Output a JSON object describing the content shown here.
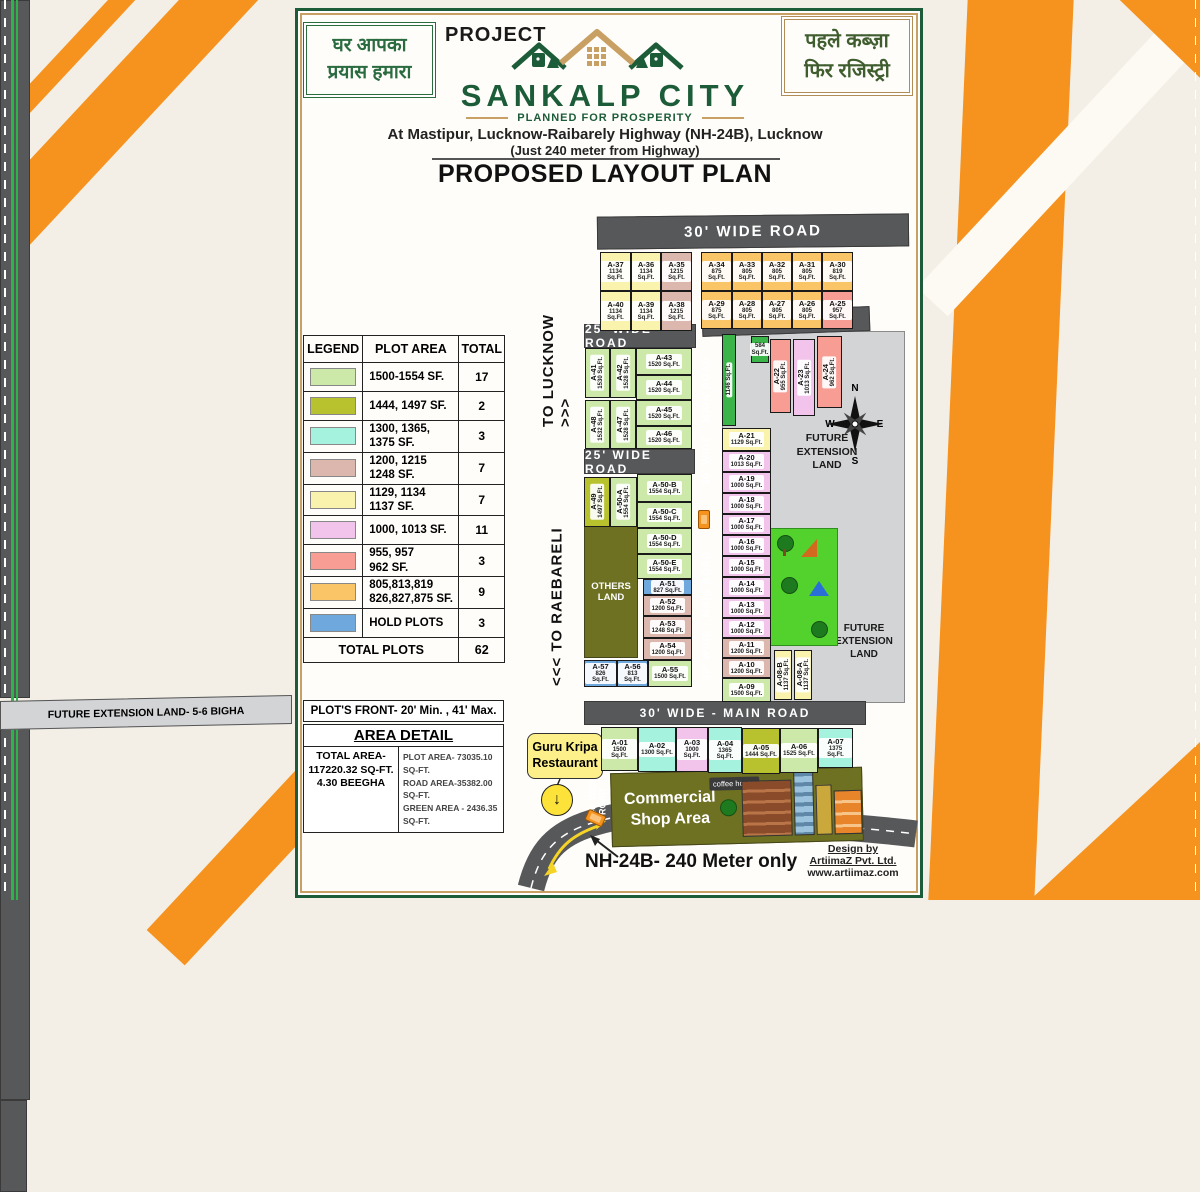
{
  "colors": {
    "brand_green": "#1d5c38",
    "brand_tan": "#c8a063",
    "ribbon_orange": "#f6921e",
    "road_gray": "#57585a"
  },
  "header": {
    "slogan_left": "घर आपका\nप्रयास हमारा",
    "slogan_right": "पहले कब्ज़ा\nफिर रजिस्ट्री",
    "project_label": "PROJECT",
    "name": "SANKALP CITY",
    "tagline": "PLANNED FOR PROSPERITY",
    "address1": "At Mastipur, Lucknow-Raibarely Highway (NH-24B), Lucknow",
    "address2": "(Just 240 meter from Highway)",
    "plan_title": "PROPOSED LAYOUT PLAN"
  },
  "legend": {
    "headers": [
      "LEGEND",
      "PLOT AREA",
      "TOTAL"
    ],
    "rows": [
      {
        "color": "#cde9a9",
        "label": "1500-1554 SF.",
        "total": "17"
      },
      {
        "color": "#b8c22e",
        "label": "1444, 1497 SF.",
        "total": "2"
      },
      {
        "color": "#a5f2df",
        "label": "1300, 1365,\n1375 SF.",
        "total": "3"
      },
      {
        "color": "#dcb7ad",
        "label": "1200, 1215\n1248 SF.",
        "total": "7"
      },
      {
        "color": "#faf3ae",
        "label": "1129, 1134\n1137 SF.",
        "total": "7"
      },
      {
        "color": "#f2c4ec",
        "label": "1000, 1013 SF.",
        "total": "11"
      },
      {
        "color": "#f89d94",
        "label": "955, 957\n962 SF.",
        "total": "3"
      },
      {
        "color": "#f9c567",
        "label": "805,813,819\n826,827,875 SF.",
        "total": "9"
      },
      {
        "color": "#6fa8dc",
        "label": "HOLD PLOTS",
        "total": "3"
      }
    ],
    "total_label": "TOTAL PLOTS",
    "total_value": "62",
    "front_note": "PLOT'S FRONT- 20' Min. , 41' Max."
  },
  "area_detail": {
    "title": "AREA DETAIL",
    "total_lines": "TOTAL AREA-\n117220.32 SQ-FT.\n4.30 BEEGHA",
    "detail_lines": "PLOT AREA- 73035.10 SQ-FT.\nROAD AREA-35382.00 SQ-FT.\nGREEN AREA - 2436.35 SQ-FT."
  },
  "map": {
    "future_top": "FUTURE EXTENSION LAND- 5-6 BIGHA",
    "future_ext": "FUTURE\nEXTENSION\nLAND",
    "others_land": "OTHERS\nLAND",
    "commercial_label": "Commercial\nShop Area",
    "coffee_label": "coffee house",
    "main_road_label": "30' WIDE - MAIN  ROAD",
    "entry_road_label": "40' WIDE - ENTRY ROAD",
    "highway": {
      "to_lucknow": "TO LUCKNOW >>>",
      "to_raebareli": "<<< TO RAEBARELI"
    },
    "compass": {
      "n": "N",
      "e": "E",
      "s": "S",
      "w": "W"
    },
    "roads": [
      {
        "label": "30' WIDE  ROAD",
        "x": 597,
        "y": 215,
        "w": 312,
        "h": 33,
        "fs": 15,
        "rot": -0.6
      },
      {
        "label": "25' WIDE ROAD",
        "x": 702,
        "y": 309,
        "w": 168,
        "h": 25,
        "fs": 12,
        "rot": -2
      },
      {
        "label": "25' WIDE ROAD",
        "x": 584,
        "y": 324,
        "w": 112,
        "h": 24,
        "fs": 12,
        "rot": 0
      },
      {
        "label": "25' WIDE  ROAD",
        "x": 584,
        "y": 449,
        "w": 111,
        "h": 25,
        "fs": 12,
        "rot": 0
      },
      {
        "label": "30' WIDE - MAIN  ROAD",
        "x": 584,
        "y": 701,
        "w": 282,
        "h": 24,
        "fs": 12,
        "rot": 0
      }
    ],
    "plot_colors": {
      "green": "#cde9a9",
      "olive": "#b8c22e",
      "cyan": "#a5f2df",
      "rose": "#dcb7ad",
      "yellow": "#faf3ae",
      "pink": "#f2c4ec",
      "salmon": "#f89d94",
      "orange": "#f9c567",
      "blue": "#6fa8dc",
      "garea": "#3bb54a"
    },
    "plots": [
      {
        "id": "A-37",
        "area": "1134 Sq.Ft.",
        "c": "yellow",
        "x": 600,
        "y": 252,
        "w": 31,
        "h": 39
      },
      {
        "id": "A-36",
        "area": "1134 Sq.Ft.",
        "c": "yellow",
        "x": 631,
        "y": 252,
        "w": 30,
        "h": 39
      },
      {
        "id": "A-35",
        "area": "1215 Sq.Ft.",
        "c": "rose",
        "x": 661,
        "y": 252,
        "w": 31,
        "h": 39
      },
      {
        "id": "A-40",
        "area": "1134 Sq.Ft.",
        "c": "yellow",
        "x": 600,
        "y": 291,
        "w": 31,
        "h": 40
      },
      {
        "id": "A-39",
        "area": "1134 Sq.Ft.",
        "c": "yellow",
        "x": 631,
        "y": 291,
        "w": 30,
        "h": 40
      },
      {
        "id": "A-38",
        "area": "1215 Sq.Ft.",
        "c": "rose",
        "x": 661,
        "y": 291,
        "w": 31,
        "h": 40
      },
      {
        "id": "A-34",
        "area": "875 Sq.Ft.",
        "c": "orange",
        "x": 701,
        "y": 252,
        "w": 31,
        "h": 39
      },
      {
        "id": "A-33",
        "area": "805 Sq.Ft.",
        "c": "orange",
        "x": 732,
        "y": 252,
        "w": 30,
        "h": 39
      },
      {
        "id": "A-32",
        "area": "805 Sq.Ft.",
        "c": "orange",
        "x": 762,
        "y": 252,
        "w": 30,
        "h": 39
      },
      {
        "id": "A-31",
        "area": "805 Sq.Ft.",
        "c": "orange",
        "x": 792,
        "y": 252,
        "w": 30,
        "h": 39
      },
      {
        "id": "A-30",
        "area": "819 Sq.Ft.",
        "c": "orange",
        "x": 822,
        "y": 252,
        "w": 31,
        "h": 39
      },
      {
        "id": "A-29",
        "area": "875 Sq.Ft.",
        "c": "orange",
        "x": 701,
        "y": 291,
        "w": 31,
        "h": 38
      },
      {
        "id": "A-28",
        "area": "805 Sq.Ft.",
        "c": "orange",
        "x": 732,
        "y": 291,
        "w": 30,
        "h": 38
      },
      {
        "id": "A-27",
        "area": "805 Sq.Ft.",
        "c": "orange",
        "x": 762,
        "y": 291,
        "w": 30,
        "h": 38
      },
      {
        "id": "A-26",
        "area": "805 Sq.Ft.",
        "c": "orange",
        "x": 792,
        "y": 291,
        "w": 30,
        "h": 38
      },
      {
        "id": "A-25",
        "area": "957 Sq.Ft.",
        "c": "salmon",
        "x": 822,
        "y": 291,
        "w": 31,
        "h": 38
      },
      {
        "id": "A-41",
        "area": "1530 Sq.Ft.",
        "c": "green",
        "x": 585,
        "y": 348,
        "w": 25,
        "h": 50,
        "rot": true
      },
      {
        "id": "A-42",
        "area": "1528 Sq.Ft.",
        "c": "green",
        "x": 610,
        "y": 348,
        "w": 26,
        "h": 50,
        "rot": true
      },
      {
        "id": "A-43",
        "area": "1520 Sq.Ft.",
        "c": "green",
        "x": 636,
        "y": 348,
        "w": 56,
        "h": 27
      },
      {
        "id": "A-44",
        "area": "1520 Sq.Ft.",
        "c": "green",
        "x": 636,
        "y": 375,
        "w": 56,
        "h": 25
      },
      {
        "id": "A-48",
        "area": "1532 Sq.Ft.",
        "c": "green",
        "x": 585,
        "y": 400,
        "w": 25,
        "h": 49,
        "rot": true
      },
      {
        "id": "A-47",
        "area": "1528 Sq.Ft.",
        "c": "green",
        "x": 610,
        "y": 400,
        "w": 26,
        "h": 49,
        "rot": true
      },
      {
        "id": "A-45",
        "area": "1520 Sq.Ft.",
        "c": "green",
        "x": 636,
        "y": 400,
        "w": 56,
        "h": 26
      },
      {
        "id": "A-46",
        "area": "1520 Sq.Ft.",
        "c": "green",
        "x": 636,
        "y": 426,
        "w": 56,
        "h": 23
      },
      {
        "id": "A-49",
        "area": "1497 Sq.Ft.",
        "c": "olive",
        "x": 584,
        "y": 477,
        "w": 26,
        "h": 50,
        "rot": true
      },
      {
        "id": "A-50-A",
        "area": "1554 Sq.Ft.",
        "c": "green",
        "x": 610,
        "y": 477,
        "w": 27,
        "h": 50,
        "rot": true
      },
      {
        "id": "A-50-B",
        "area": "1554 Sq.Ft.",
        "c": "green",
        "x": 637,
        "y": 474,
        "w": 55,
        "h": 28
      },
      {
        "id": "A-50-C",
        "area": "1554 Sq.Ft.",
        "c": "green",
        "x": 637,
        "y": 502,
        "w": 55,
        "h": 26
      },
      {
        "id": "A-50-D",
        "area": "1554 Sq.Ft.",
        "c": "green",
        "x": 637,
        "y": 528,
        "w": 55,
        "h": 26
      },
      {
        "id": "A-50-E",
        "area": "1554 Sq.Ft.",
        "c": "green",
        "x": 637,
        "y": 554,
        "w": 55,
        "h": 25
      },
      {
        "id": "A-51",
        "area": "827 Sq.Ft.",
        "c": "blue",
        "x": 643,
        "y": 579,
        "w": 49,
        "h": 16
      },
      {
        "id": "A-52",
        "area": "1200 Sq.Ft.",
        "c": "rose",
        "x": 643,
        "y": 595,
        "w": 49,
        "h": 21
      },
      {
        "id": "A-53",
        "area": "1248 Sq.Ft.",
        "c": "rose",
        "x": 643,
        "y": 616,
        "w": 49,
        "h": 22
      },
      {
        "id": "A-54",
        "area": "1200 Sq.Ft.",
        "c": "rose",
        "x": 643,
        "y": 638,
        "w": 49,
        "h": 22
      },
      {
        "id": "A-55",
        "area": "1500 Sq.Ft.",
        "c": "green",
        "x": 648,
        "y": 660,
        "w": 44,
        "h": 27
      },
      {
        "id": "A-56",
        "area": "813 Sq.Ft.",
        "c": "blue",
        "x": 617,
        "y": 660,
        "w": 31,
        "h": 27
      },
      {
        "id": "A-57",
        "area": "826 Sq.Ft.",
        "c": "blue",
        "x": 584,
        "y": 660,
        "w": 33,
        "h": 27
      },
      {
        "id": "A-21",
        "area": "1129 Sq.Ft.",
        "c": "yellow",
        "x": 722,
        "y": 428,
        "w": 49,
        "h": 23
      },
      {
        "id": "A-20",
        "area": "1013 Sq.Ft.",
        "c": "pink",
        "x": 722,
        "y": 451,
        "w": 49,
        "h": 21
      },
      {
        "id": "A-19",
        "area": "1000 Sq.Ft.",
        "c": "pink",
        "x": 722,
        "y": 472,
        "w": 49,
        "h": 21
      },
      {
        "id": "A-18",
        "area": "1000 Sq.Ft.",
        "c": "pink",
        "x": 722,
        "y": 493,
        "w": 49,
        "h": 21
      },
      {
        "id": "A-17",
        "area": "1000 Sq.Ft.",
        "c": "pink",
        "x": 722,
        "y": 514,
        "w": 49,
        "h": 21
      },
      {
        "id": "A-16",
        "area": "1000 Sq.Ft.",
        "c": "pink",
        "x": 722,
        "y": 535,
        "w": 49,
        "h": 21
      },
      {
        "id": "A-15",
        "area": "1000 Sq.Ft.",
        "c": "pink",
        "x": 722,
        "y": 556,
        "w": 49,
        "h": 21
      },
      {
        "id": "A-14",
        "area": "1000 Sq.Ft.",
        "c": "pink",
        "x": 722,
        "y": 577,
        "w": 49,
        "h": 21
      },
      {
        "id": "A-13",
        "area": "1000 Sq.Ft.",
        "c": "pink",
        "x": 722,
        "y": 598,
        "w": 49,
        "h": 20
      },
      {
        "id": "A-12",
        "area": "1000 Sq.Ft.",
        "c": "pink",
        "x": 722,
        "y": 618,
        "w": 49,
        "h": 20
      },
      {
        "id": "A-11",
        "area": "1200 Sq.Ft.",
        "c": "rose",
        "x": 722,
        "y": 638,
        "w": 49,
        "h": 20
      },
      {
        "id": "A-10",
        "area": "1200 Sq.Ft.",
        "c": "rose",
        "x": 722,
        "y": 658,
        "w": 49,
        "h": 20
      },
      {
        "id": "A-09",
        "area": "1500 Sq.Ft.",
        "c": "green",
        "x": 722,
        "y": 678,
        "w": 49,
        "h": 24
      },
      {
        "id": "A-08-B",
        "area": "1137 Sq.Ft.",
        "c": "yellow",
        "x": 774,
        "y": 650,
        "w": 18,
        "h": 50,
        "rot": true
      },
      {
        "id": "A-08-A",
        "area": "1137 Sq.Ft.",
        "c": "yellow",
        "x": 794,
        "y": 650,
        "w": 18,
        "h": 50,
        "rot": true
      },
      {
        "id": "A-22",
        "area": "955 Sq.Ft.",
        "c": "salmon",
        "x": 770,
        "y": 339,
        "w": 21,
        "h": 74,
        "rot": true
      },
      {
        "id": "A-23",
        "area": "1013 Sq.Ft.",
        "c": "pink",
        "x": 793,
        "y": 339,
        "w": 22,
        "h": 77,
        "rot": true
      },
      {
        "id": "A-24",
        "area": "962 Sq.Ft.",
        "c": "salmon",
        "x": 817,
        "y": 336,
        "w": 25,
        "h": 72,
        "rot": true
      },
      {
        "id": "",
        "area": "584 Sq.Ft.",
        "c": "garea",
        "x": 751,
        "y": 336,
        "w": 18,
        "h": 27
      },
      {
        "id": "",
        "area": "1146 Sq.Ft.",
        "c": "garea",
        "x": 722,
        "y": 334,
        "w": 14,
        "h": 92,
        "rot": true
      },
      {
        "id": "A-01",
        "area": "1500 Sq.Ft.",
        "c": "green",
        "x": 601,
        "y": 727,
        "w": 37,
        "h": 44
      },
      {
        "id": "A-02",
        "area": "1300 Sq.Ft.",
        "c": "cyan",
        "x": 638,
        "y": 727,
        "w": 38,
        "h": 45
      },
      {
        "id": "A-03",
        "area": "1000 Sq.Ft.",
        "c": "pink",
        "x": 676,
        "y": 727,
        "w": 32,
        "h": 45
      },
      {
        "id": "A-04",
        "area": "1365 Sq.Ft.",
        "c": "cyan",
        "x": 708,
        "y": 727,
        "w": 34,
        "h": 46
      },
      {
        "id": "A-05",
        "area": "1444 Sq.Ft.",
        "c": "olive",
        "x": 742,
        "y": 728,
        "w": 38,
        "h": 46
      },
      {
        "id": "A-06",
        "area": "1525 Sq.Ft.",
        "c": "green",
        "x": 780,
        "y": 728,
        "w": 38,
        "h": 45
      },
      {
        "id": "A-07",
        "area": "1375 Sq.Ft.",
        "c": "cyan",
        "x": 818,
        "y": 728,
        "w": 35,
        "h": 40
      }
    ]
  },
  "footer": {
    "restaurant": "Guru Kripa\nRestaurant",
    "marker_arrow": "↓",
    "nh_text": "NH-24B- 240 Meter only",
    "credit1": "Design by",
    "credit2": "ArtiimaZ Pvt. Ltd.",
    "credit3": "www.artiimaz.com"
  }
}
